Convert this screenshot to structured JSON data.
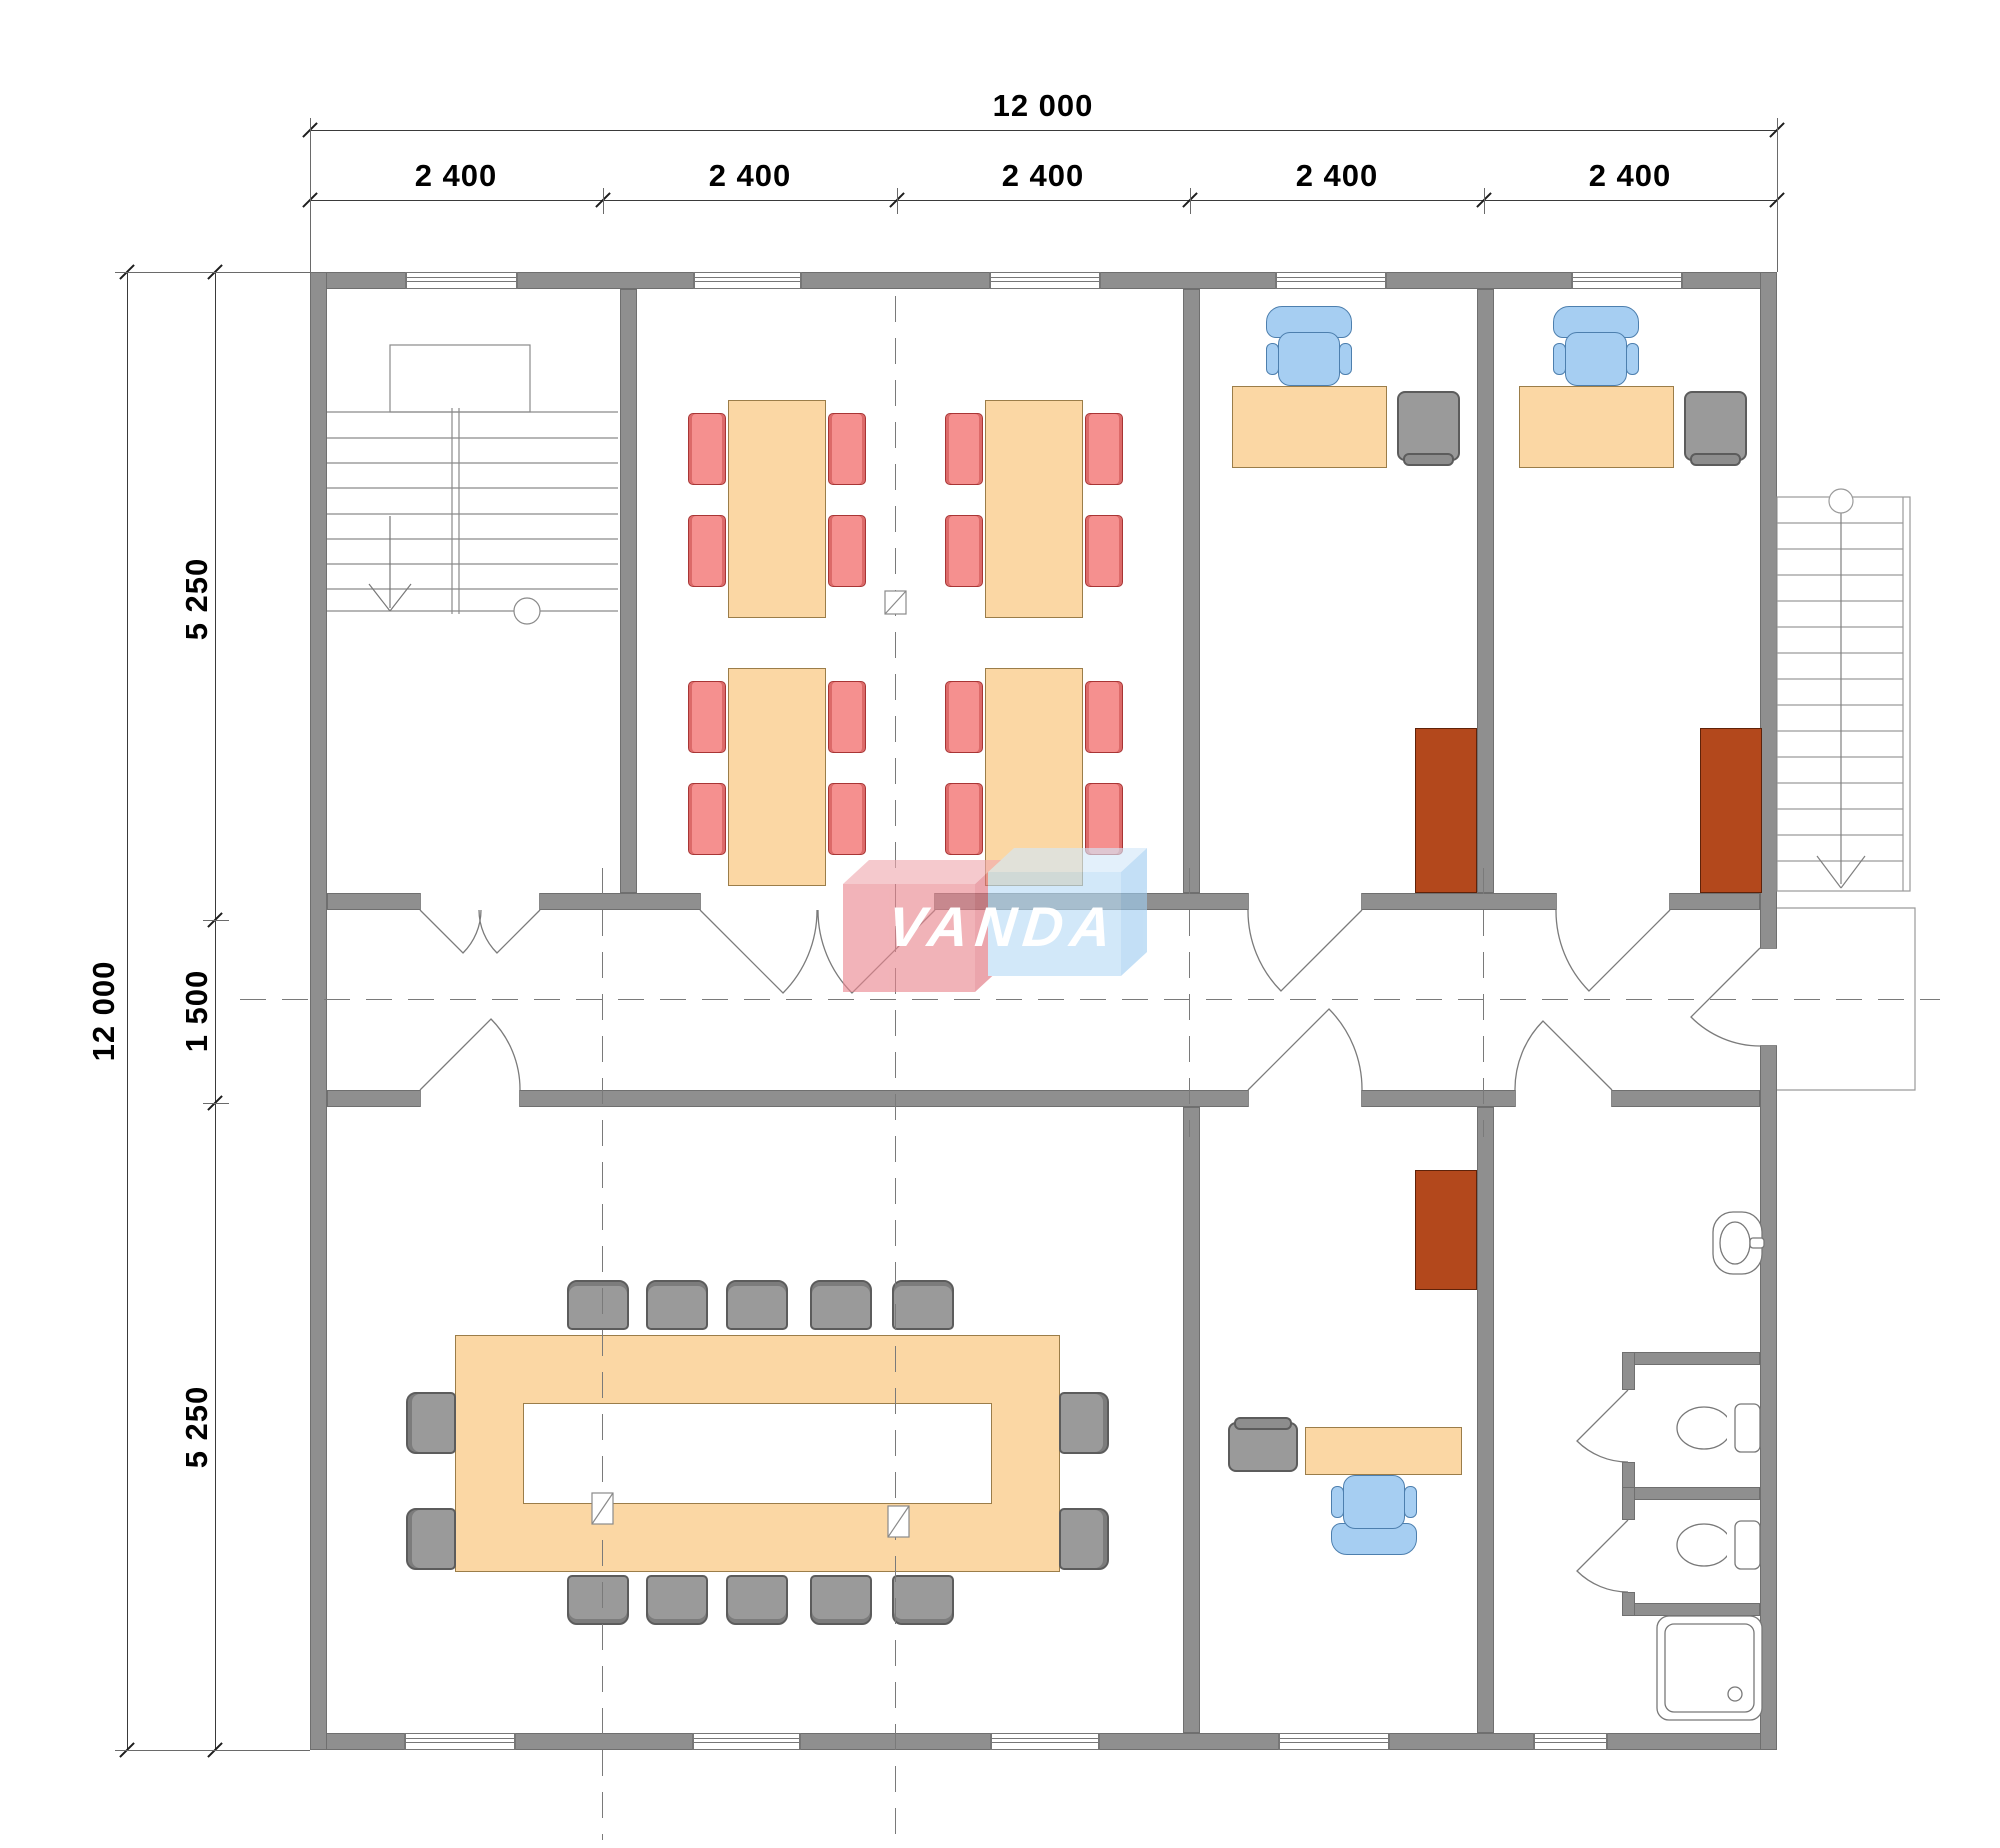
{
  "logo": {
    "text": "VANDA",
    "pink": "#ea858e",
    "blue": "#b7dbf6"
  },
  "dimensions": {
    "top": {
      "total": "12 000",
      "segments": [
        "2 400",
        "2 400",
        "2 400",
        "2 400",
        "2 400"
      ]
    },
    "left": {
      "total": "12 000",
      "segments": [
        "5 250",
        "1 500",
        "5 250"
      ]
    }
  },
  "colors": {
    "wall": "#8f8f8f",
    "wood_furniture": "#fbd7a4",
    "chair_red": "#f5908f",
    "chair_blue": "#a6cef2",
    "chair_gray": "#9a9a9a",
    "cabinet_brown": "#b3481c"
  },
  "plan": {
    "building_grid_mm": {
      "bays": [
        2400,
        2400,
        2400,
        2400,
        2400
      ],
      "rows": [
        5250,
        1500,
        5250
      ]
    },
    "rooms": [
      "stairwell",
      "open-room-with-4-tables-16-red-chairs",
      "office-1-desk-task-chair-guest-chair-cabinet",
      "office-2-desk-task-chair-guest-chair-cabinet",
      "corridor",
      "conference-room-ring-table-14-chairs",
      "office-3-desk-task-chair-guest-chair-cabinet",
      "washroom-sink-2-wc-stalls-shower",
      "exterior-stair-with-porch"
    ]
  }
}
